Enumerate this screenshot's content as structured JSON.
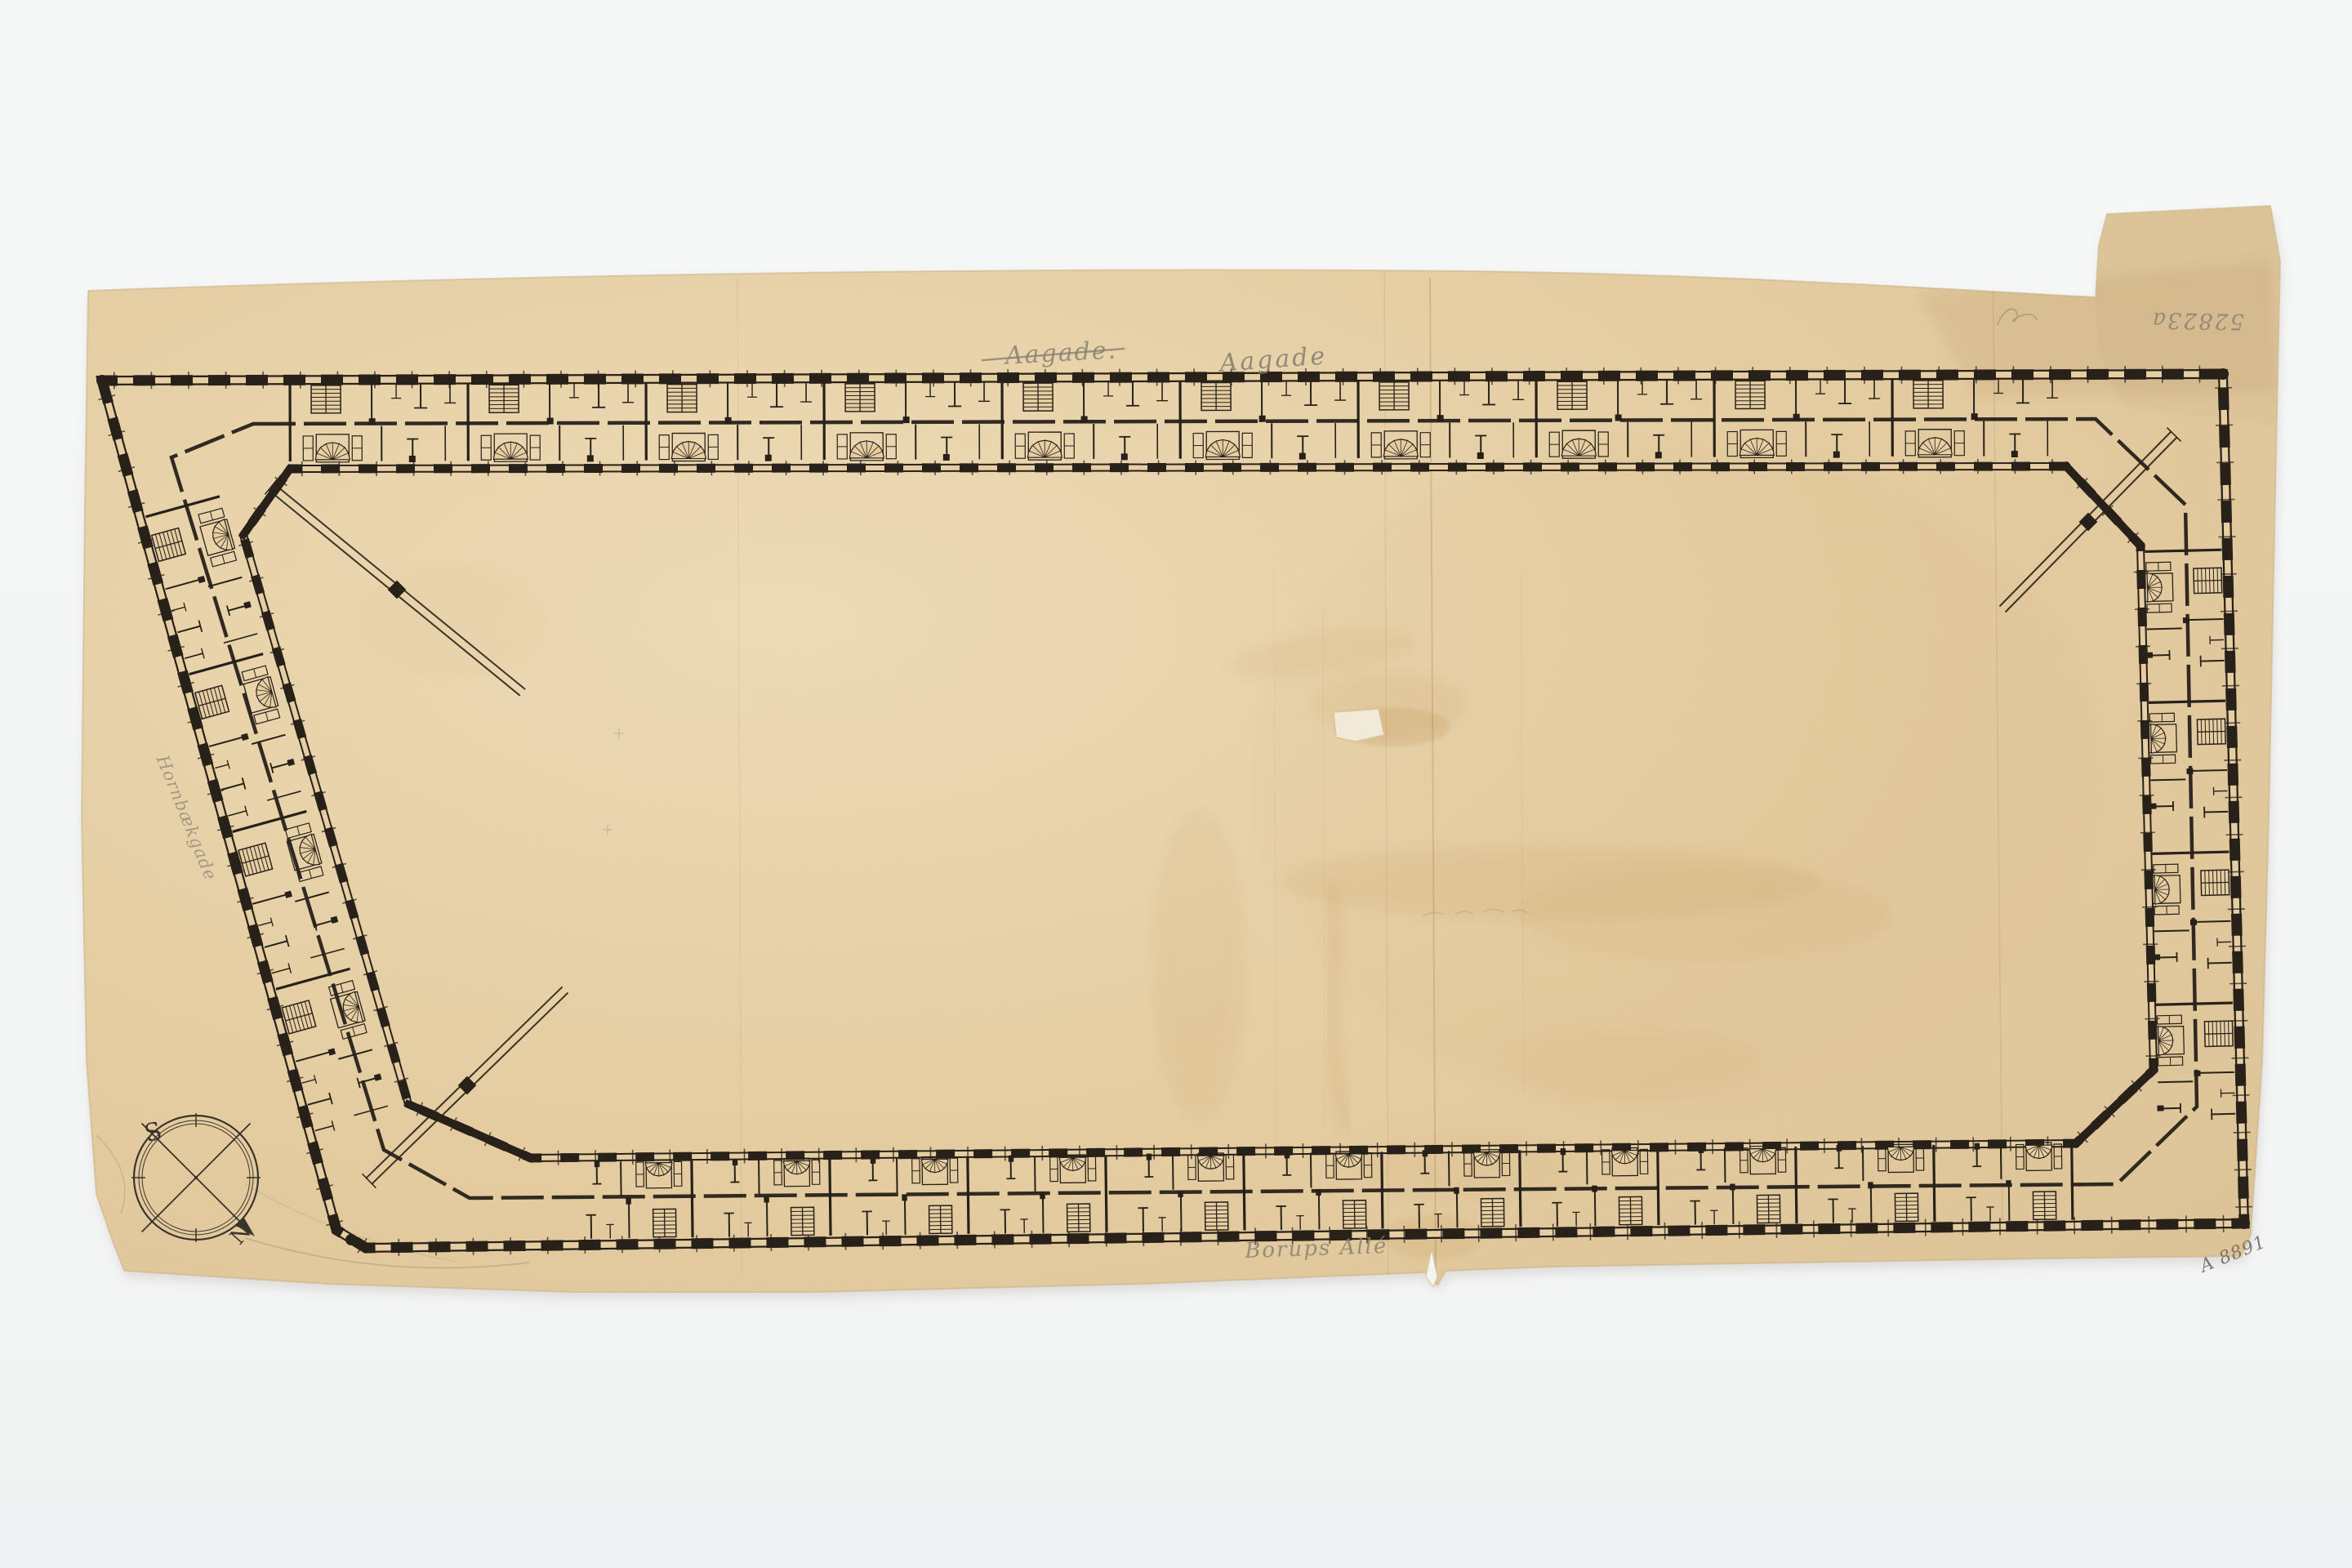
{
  "annotations": {
    "street_top_struck": "Aagade.",
    "street_top": "Aagade",
    "street_bottom": "Borups Allé",
    "street_left": "Hornbækgade",
    "inventory_number_top_right": "52823a",
    "inventory_number_bottom_right": "A 8891",
    "compass": {
      "south_label": "S",
      "north_label": "N"
    }
  },
  "colors": {
    "background": "#f5f7f7",
    "paper": "#e6cea2",
    "paper_light": "#eedcb8",
    "paper_shadowed": "#d9c096",
    "ink": "#27211a",
    "pencil": "#8b8273",
    "stain": "#c1915a"
  }
}
